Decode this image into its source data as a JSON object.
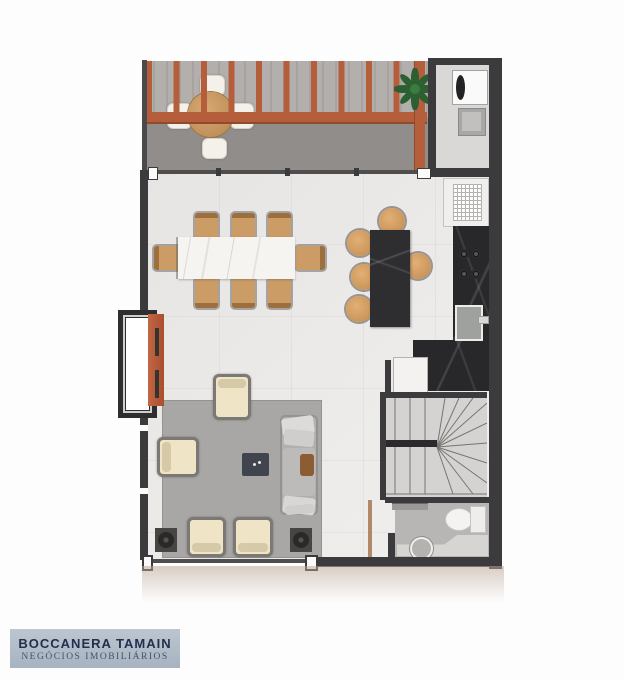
{
  "branding": {
    "name": "BOCCANERA TAMAIN",
    "tagline": "NEGÓCIOS IMOBILIÁRIOS"
  },
  "colors": {
    "wall": "#3b3b3d",
    "pergola": "#b45e3b",
    "pergoladark": "#93492c",
    "deckstripea": "#b3afac",
    "deckstripeb": "#a7a3a0",
    "decksolid": "#918d8a",
    "floor": "#e7e5e3",
    "rug": "#a8a7a5",
    "svcfloor": "#dad8d6",
    "stairfloor": "#d5d3d1",
    "bathfloor": "#b8b6b4",
    "counter": "#28282b",
    "island": "#2e2e31",
    "wood": "#cb9c65",
    "wooddark": "#9c6f3c",
    "cream": "#efe4c5",
    "frame": "#7b7975",
    "sofa": "#b1b0ae",
    "glass": "#504e4c",
    "doorwood": "#b08968",
    "logobg": "#bcc6d0",
    "logobg2": "#a6b3c0",
    "logotext": "#232f4e",
    "logosub": "#46516b",
    "plant": "#2f6d35"
  },
  "floorplan": {
    "areas": [
      "pergola-deck",
      "service-area",
      "kitchen",
      "dining-area",
      "living-room",
      "winder-staircase",
      "bathroom",
      "hall"
    ],
    "visible_items": {
      "deck_round_table_chairs": 4,
      "dining_chairs": 8,
      "island_stools": 5,
      "armchairs": 4,
      "sofas": 1,
      "cooktop_burners": 4,
      "plants": 1
    }
  }
}
